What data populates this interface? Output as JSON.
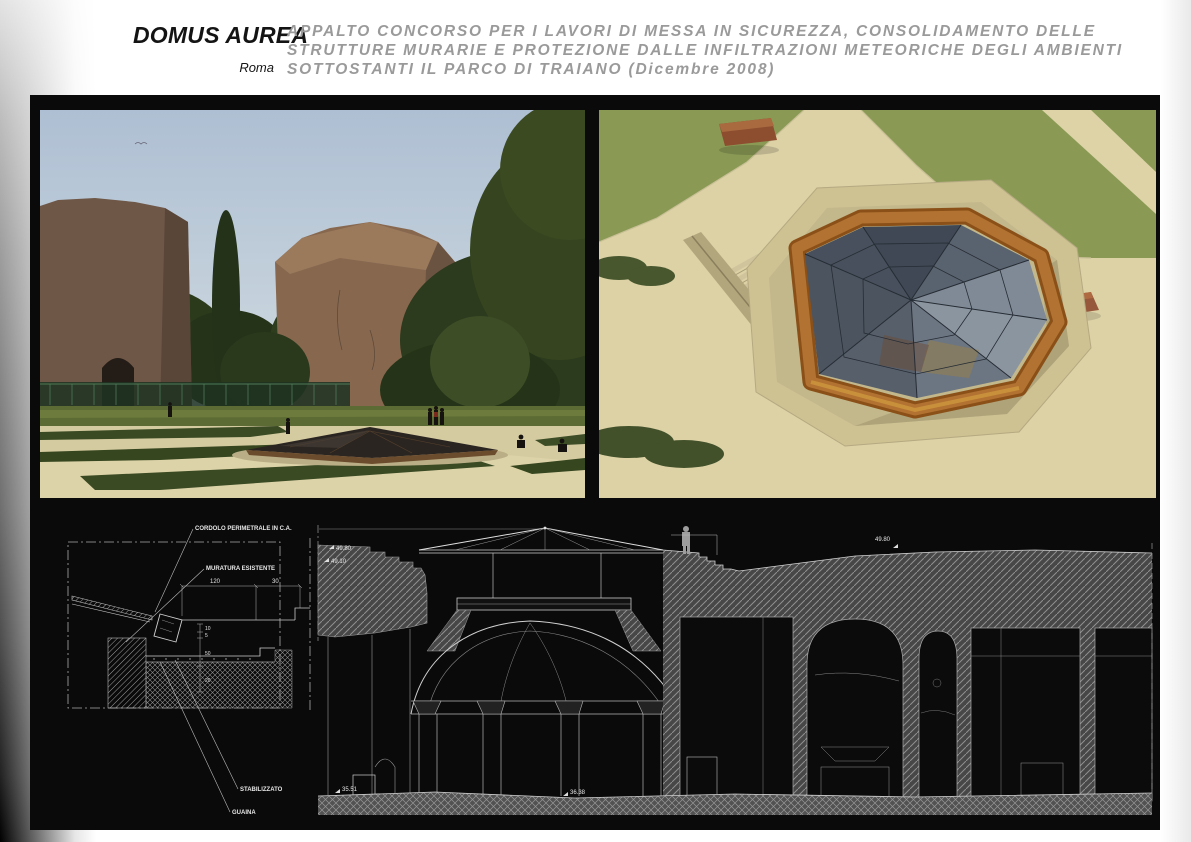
{
  "header": {
    "brand": "DOMUS AUREA",
    "city": "Roma",
    "title_lines": [
      "APPALTO CONCORSO PER I LAVORI DI MESSA IN SICUREZZA, CONSOLIDAMENTO DELLE",
      "STRUTTURE MURARIE E PROTEZIONE DALLE INFILTRAZIONI METEORICHE DEGLI AMBIENTI",
      "SOTTOSTANTI IL PARCO DI TRAIANO (Dicembre 2008)"
    ]
  },
  "detail_drawing": {
    "labels": {
      "cordolo": "CORDOLO PERIMETRALE IN C.A.",
      "muratura": "MURATURA ESISTENTE",
      "stabilizzato": "STABILIZZATO",
      "guaina": "GUAINA"
    },
    "dimensions": {
      "width_main": "120",
      "width_edge": "30",
      "v1": "10",
      "v2": "5",
      "v3": "50",
      "v4": "20"
    }
  },
  "section_drawing": {
    "levels": {
      "left_upper": "49.80",
      "left_lower": "49.10",
      "right_ground": "49.80",
      "floor_left": "35.51",
      "floor_center": "36.38"
    }
  },
  "palette": {
    "board_background": "#0a0a0a",
    "title_gray": "#9a9a9a",
    "drawing_lines": "#c8c8c8",
    "wood_frame": "#a8661f",
    "lawn_green": "#8a9a55",
    "gravel": "#dcd2a6"
  }
}
